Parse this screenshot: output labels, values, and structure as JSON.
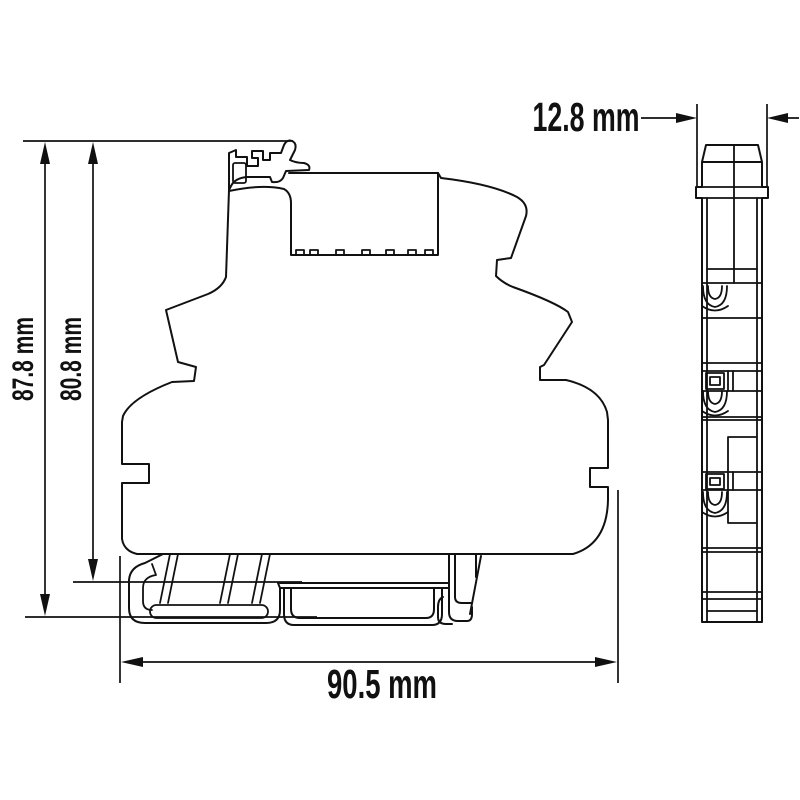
{
  "drawing": {
    "background": "#ffffff",
    "line_color": "#111111",
    "unit": "mm",
    "dimensions": {
      "overall_height": {
        "value": 87.8,
        "label": "87.8 mm"
      },
      "rail_height": {
        "value": 80.8,
        "label": "80.8 mm"
      },
      "overall_width": {
        "value": 90.5,
        "label": "90.5 mm"
      },
      "overall_depth": {
        "value": 12.8,
        "label": "12.8 mm"
      }
    }
  }
}
